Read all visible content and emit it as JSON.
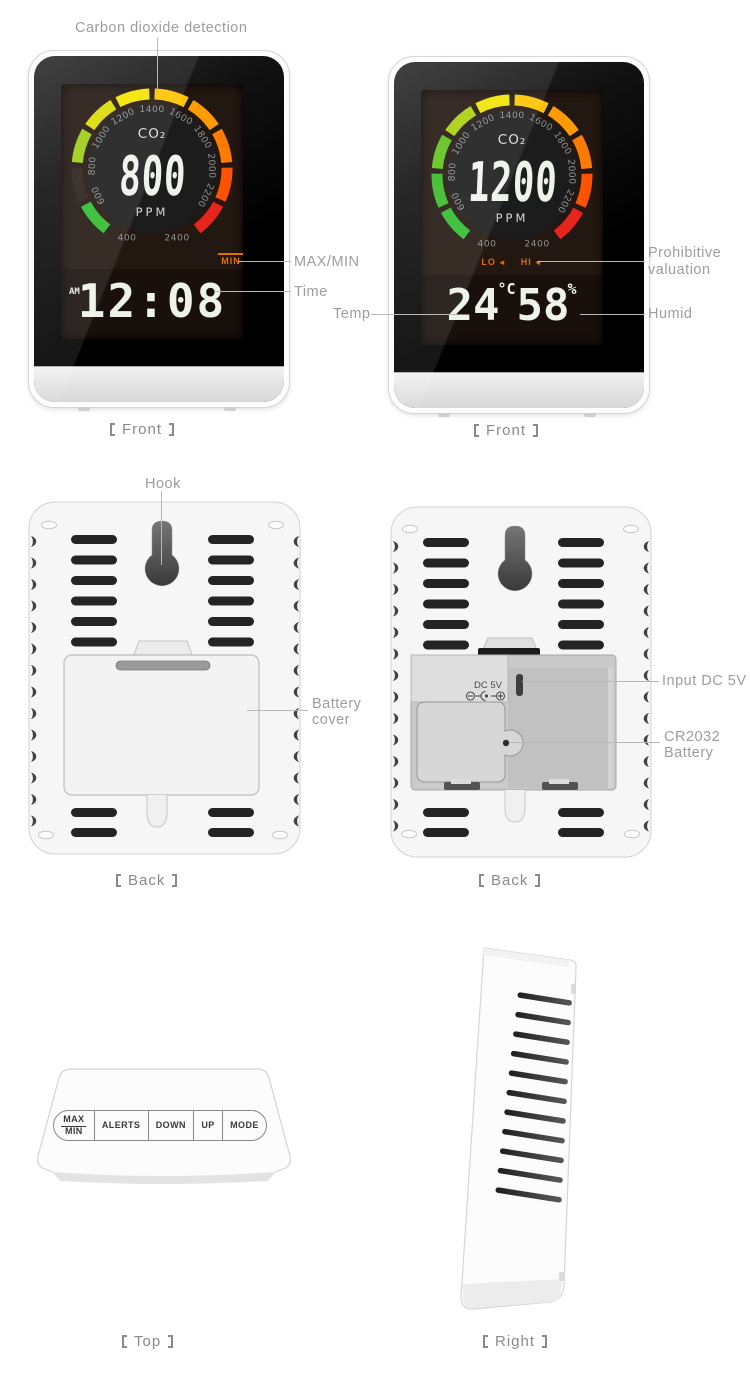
{
  "annotations": {
    "co2_detection": "Carbon dioxide detection",
    "max_min": "MAX/MIN",
    "time": "Time",
    "temp": "Temp",
    "prohibitive_line1": "Prohibitive",
    "prohibitive_line2": "valuation",
    "humid": "Humid",
    "hook": "Hook",
    "battery_line1": "Battery",
    "battery_line2": "cover",
    "input_dc": "Input DC 5V",
    "cr2032_line1": "CR2032",
    "cr2032_line2": "Battery"
  },
  "views": {
    "bracket_left": "【",
    "bracket_right": "】",
    "front1": "Front",
    "front2": "Front",
    "back1": "Back",
    "back2": "Back",
    "top": "Top",
    "right": "Right"
  },
  "gauge": {
    "co2_label": "CO₂",
    "unit": "PPM",
    "ticks": [
      "400",
      "600",
      "800",
      "1000",
      "1200",
      "1400",
      "1600",
      "1800",
      "2000",
      "2200",
      "2400"
    ],
    "front1_value": "800",
    "front2_value": "1200",
    "front1_segment_colors": [
      "#2fbb2f",
      "#2a211a",
      "#9bcb12",
      "#d8dc03",
      "#f4e400",
      "#ffc400",
      "#ff9b00",
      "#ff7b00",
      "#ff5200",
      "#e8251a"
    ],
    "front2_segment_colors": [
      "#2fbb2f",
      "#3aba28",
      "#62c31c",
      "#a9cf0d",
      "#f0e300",
      "#ffc400",
      "#ff9b00",
      "#ff7b00",
      "#ff5200",
      "#e8251a"
    ]
  },
  "front1": {
    "min_indicator": "MIN",
    "meridiem": "AM",
    "time": "12:08"
  },
  "front2": {
    "lo": "LO",
    "hi": "HI",
    "speaker": "◄",
    "temp_value": "24",
    "temp_unit": "°C",
    "humid_value": "58",
    "humid_unit": "%"
  },
  "back2": {
    "dc_label": "DC 5V",
    "polarity": "⊖-●-⊕"
  },
  "top_view": {
    "buttons": {
      "maxmin_top": "MAX",
      "maxmin_bottom": "MIN",
      "alerts": "ALERTS",
      "down": "DOWN",
      "up": "UP",
      "mode": "MODE"
    }
  },
  "colors": {
    "accent_orange": "#e07000",
    "annotation_text": "#9d9d9d",
    "leader_line": "#b8b8b8",
    "lcd_digits": "#eef3ea",
    "screen_bg": "#231711",
    "body_white": "#fcfcfc"
  }
}
